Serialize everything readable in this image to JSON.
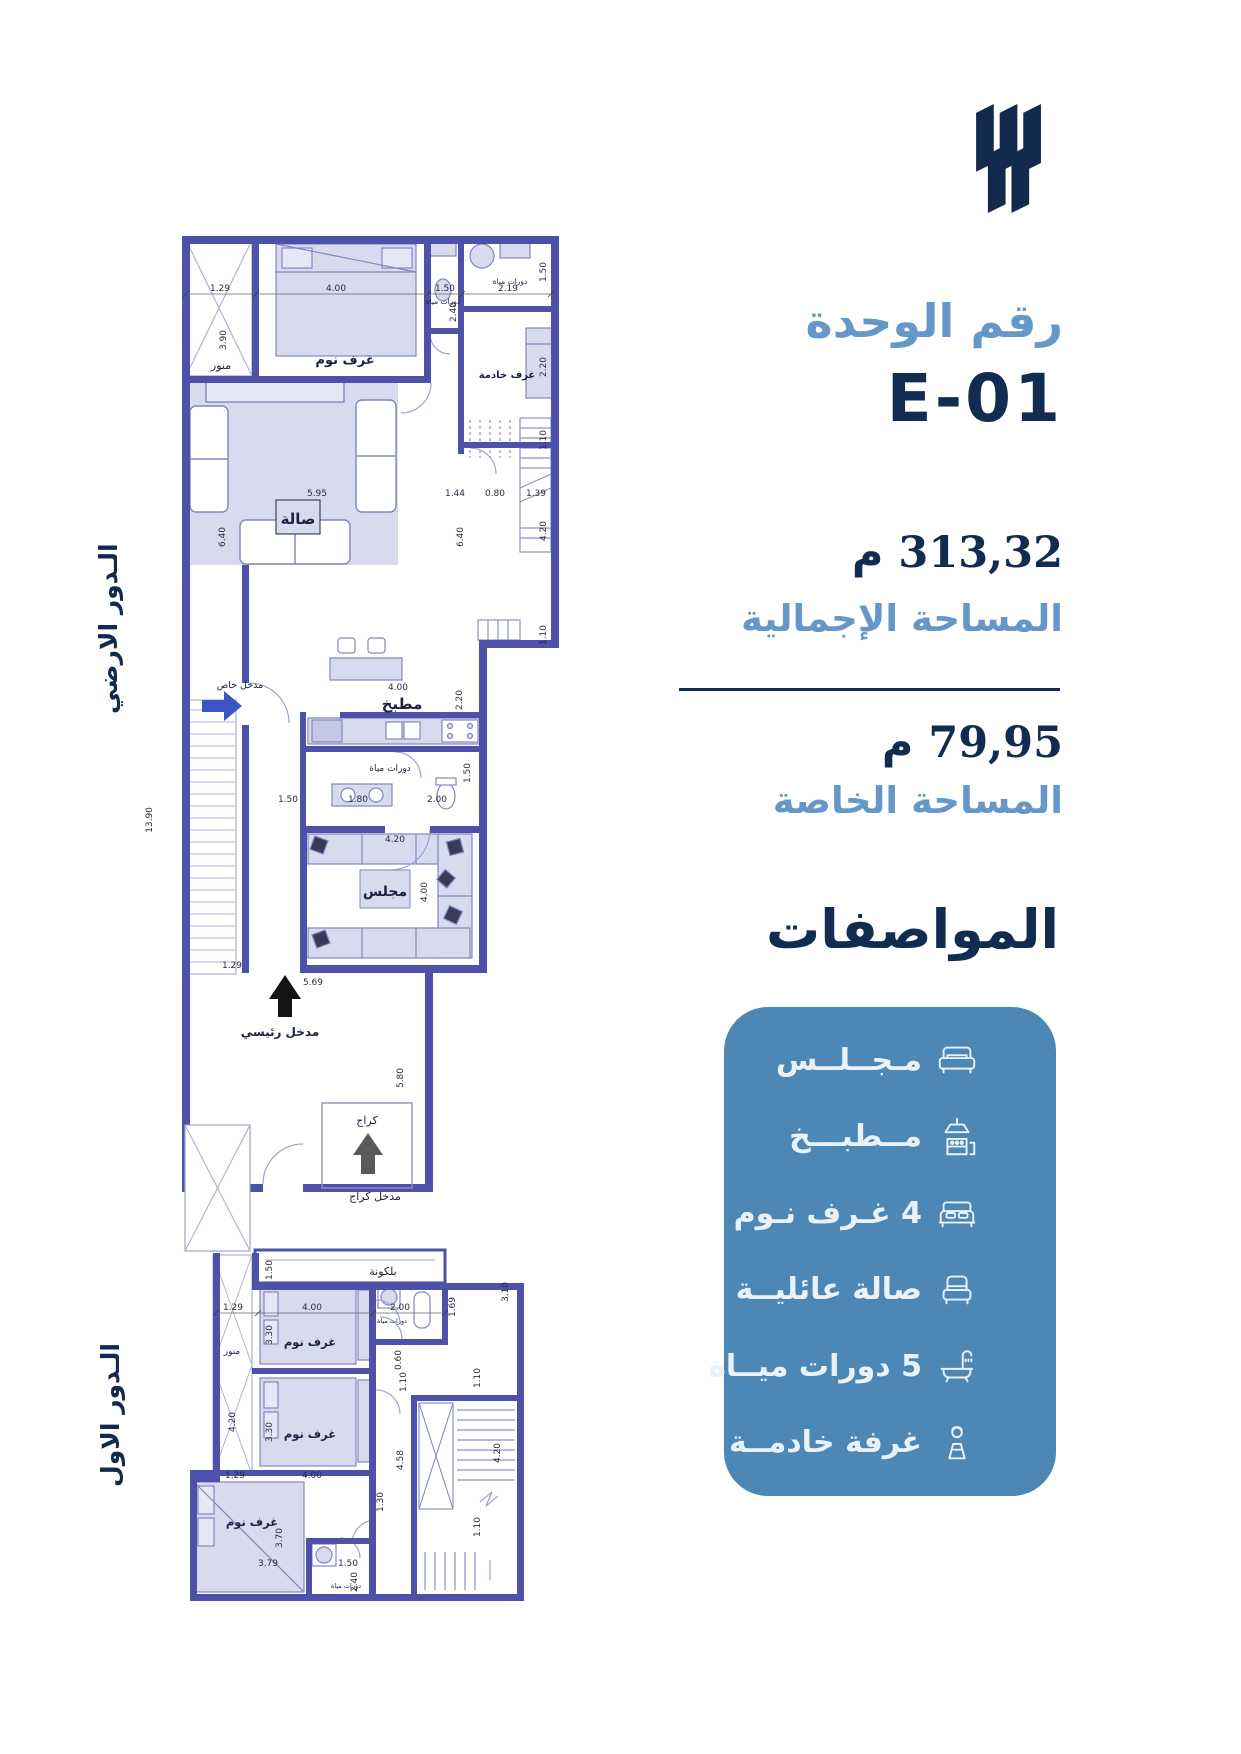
{
  "unit": {
    "label": "رقم الوحدة",
    "number": "E-01",
    "total_area_value": "313,32 م",
    "total_area_label": "المساحة الإجمالية",
    "private_area_value": "79,95 م",
    "private_area_label": "المساحة الخاصة"
  },
  "specs": {
    "title": "المواصفات",
    "box_color": "#4d87b5",
    "text_color": "#e9f2f8",
    "items": [
      {
        "label": "مـجــلــس",
        "icon": "sofa-icon"
      },
      {
        "label": "مــطبـــخ",
        "icon": "kitchen-icon"
      },
      {
        "label": "4 غـرف نـوم",
        "icon": "bed-icon"
      },
      {
        "label": "صالة عائليــة",
        "icon": "armchair-icon"
      },
      {
        "label": "5 دورات ميــاة",
        "icon": "bath-icon"
      },
      {
        "label": "غرفة خادمــة",
        "icon": "maid-icon"
      }
    ]
  },
  "colors": {
    "navy": "#122b50",
    "light_blue": "#6598c9",
    "wall": "#4d51a9",
    "room_fill": "#d8daee"
  },
  "floors": {
    "ground": {
      "name": "الـدور الارضي",
      "rooms": {
        "lightwell": "منور",
        "bedroom": "غرف نوم",
        "bath_top1": "دورات مياة",
        "bath_top2": "دورات مياة",
        "maid": "غرف خادمة",
        "hall": "صالة",
        "kitchen": "مطبخ",
        "bath_mid": "دورات مياة",
        "majlis": "مجلس",
        "entrance_private": "مدخل خاص",
        "entrance_main": "مدخل رئيسي",
        "garage": "كراج",
        "entrance_garage": "مدخل كراج"
      },
      "dims": [
        "1.29",
        "4.00",
        "1.50",
        "2.19",
        "1.50",
        "3.90",
        "2.40",
        "2.20",
        "1.10",
        "5.95",
        "6.40",
        "1.44",
        "0.80",
        "1.39",
        "6.40",
        "4.20",
        "1.10",
        "4.00",
        "2.20",
        "1.50",
        "1.80",
        "2.00",
        "1.50",
        "4.20",
        "4.00",
        "13.90",
        "1.29",
        "5.69",
        "5.80"
      ]
    },
    "first": {
      "name": "الـدور الاول",
      "rooms": {
        "balcony": "بلكونة",
        "lightwell": "منور",
        "bedroom1": "غرف نوم",
        "bedroom2": "غرف نوم",
        "bedroom3": "غرف نوم",
        "bath_top": "دورات مياة",
        "bath_bottom": "دورات مياة"
      },
      "dims": [
        "1.50",
        "1.29",
        "4.00",
        "2.00",
        "1.69",
        "3.10",
        "3.30",
        "3.30",
        "4.00",
        "1.29",
        "4.20",
        "0.60",
        "1.10",
        "1.10",
        "4.58",
        "4.20",
        "1.30",
        "1.10",
        "3.70",
        "3.79",
        "1.50",
        "2.40"
      ]
    }
  }
}
